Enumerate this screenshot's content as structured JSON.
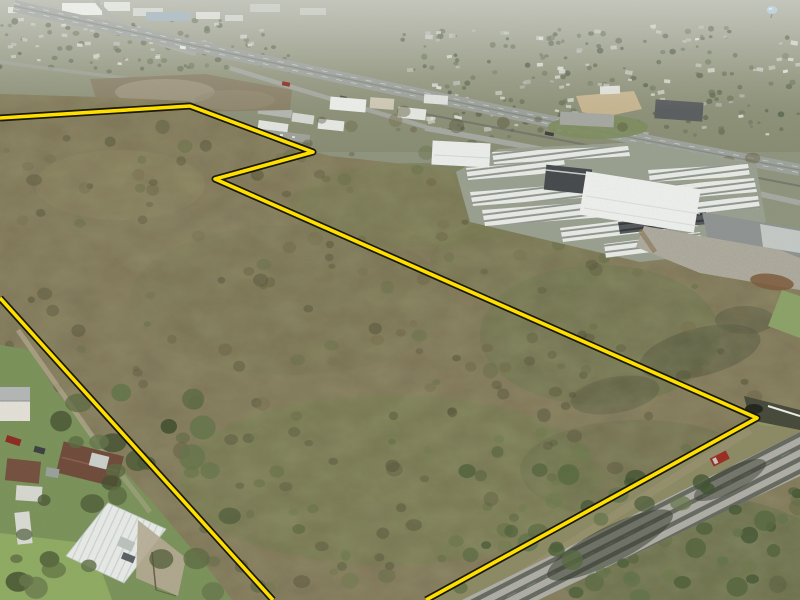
{
  "meta": {
    "type": "aerial-drone-photograph",
    "subject": "Aerial photo of wooded acreage for sale with yellow property boundary outline, bordered by a highway, RV dealership, rural road and small neighborhood",
    "width": 800,
    "height": 600
  },
  "palette": {
    "boundary_yellow": "#ffdf00",
    "boundary_outline": "#191807",
    "haze_top": "#aeb1a4",
    "suburb": "#8f947e",
    "forest_base": "#7d7254",
    "forest_green": "#6c7a47",
    "lawn_green": "#7b925a",
    "field_green": "#8fab62",
    "road_gray": "#aeaea6",
    "highway_gray": "#9da29d",
    "concrete": "#b1aea1",
    "warehouse_white": "#eef0ee",
    "truck_red": "#9a2c22"
  },
  "boundary": {
    "stroke_color": "#ffdf00",
    "outline_color": "#191807",
    "stroke_width": 3.6,
    "outline_width": 7,
    "polylines": [
      {
        "name": "northeast-boundary-line",
        "points": "0,118 190,106 313,152 215,179 757,418 426,600"
      },
      {
        "name": "west-boundary-line",
        "points": "0,298 273,600"
      }
    ]
  },
  "landmarks": [
    "wooded-parcel",
    "property-boundary",
    "interstate-highway",
    "frontage-road",
    "distant-city",
    "water-tower",
    "school-campus",
    "commercial-buildings",
    "rv-dealership",
    "warehouses",
    "concrete-pad",
    "country-road",
    "bridge-culvert",
    "red-pickup-truck",
    "neighborhood",
    "white-metal-building"
  ],
  "rv_rows": [
    {
      "pts": "492,152 628,146 630,156 494,164",
      "fill": "light"
    },
    {
      "pts": "466,168 564,160 566,172 468,180",
      "fill": "light"
    },
    {
      "pts": "470,192 604,182 607,196 473,206",
      "fill": "light"
    },
    {
      "pts": "482,210 642,198 645,214 485,226",
      "fill": "light"
    },
    {
      "pts": "560,228 662,216 665,230 563,242",
      "fill": "light"
    },
    {
      "pts": "604,244 700,232 702,246 606,258",
      "fill": "light"
    },
    {
      "pts": "648,170 748,164 750,176 650,182",
      "fill": "light"
    },
    {
      "pts": "656,186 754,178 757,192 659,200",
      "fill": "light"
    },
    {
      "pts": "664,204 758,196 760,208 666,216",
      "fill": "light"
    },
    {
      "pts": "618,222 706,212 708,224 620,234",
      "fill": "dark"
    }
  ],
  "scatter": [
    {
      "name": "suburb-houses-right",
      "kind": "rect",
      "region": [
        400,
        25,
        398,
        110
      ],
      "count": 95,
      "size": [
        2,
        4.5
      ],
      "colors": [
        "#e8e8e2",
        "#d8d8d0",
        "#c9ccc4",
        "#b8bcb4"
      ],
      "opacity": 0.9,
      "seed": 11
    },
    {
      "name": "suburb-houses-left",
      "kind": "rect",
      "region": [
        0,
        18,
        260,
        46
      ],
      "count": 42,
      "size": [
        2,
        4
      ],
      "colors": [
        "#e6e6df",
        "#cfd2ca",
        "#c2c6be"
      ],
      "opacity": 0.85,
      "seed": 12
    },
    {
      "name": "suburb-trees-right",
      "kind": "dot",
      "region": [
        395,
        28,
        405,
        112
      ],
      "count": 150,
      "size": [
        1.5,
        3.5
      ],
      "colors": [
        "#5f6a50",
        "#6b765a",
        "#55604a",
        "#727c62"
      ],
      "opacity": 0.8,
      "seed": 13
    },
    {
      "name": "suburb-trees-left",
      "kind": "dot",
      "region": [
        0,
        20,
        290,
        52
      ],
      "count": 70,
      "size": [
        1.5,
        3.5
      ],
      "colors": [
        "#636e54",
        "#6e785e",
        "#59644c"
      ],
      "opacity": 0.75,
      "seed": 14
    },
    {
      "name": "forest-clumps",
      "kind": "dot",
      "region": [
        5,
        110,
        750,
        330
      ],
      "count": 175,
      "size": [
        3,
        8
      ],
      "colors": [
        "#6b6243",
        "#59573c",
        "#776f4c",
        "#646e46",
        "#4f4f36"
      ],
      "opacity": 0.5,
      "seed": 21
    },
    {
      "name": "forest-clumps-lower",
      "kind": "dot",
      "region": [
        180,
        430,
        620,
        165
      ],
      "count": 90,
      "size": [
        4,
        9
      ],
      "colors": [
        "#5d6b40",
        "#4e5c36",
        "#6b7a4a",
        "#55533a"
      ],
      "opacity": 0.5,
      "seed": 22
    },
    {
      "name": "yard-trees",
      "kind": "dot",
      "region": [
        0,
        360,
        240,
        238
      ],
      "count": 30,
      "size": [
        6,
        14
      ],
      "colors": [
        "#4d5a36",
        "#5a6a40",
        "#435030",
        "#64744a"
      ],
      "opacity": 0.9,
      "seed": 31
    },
    {
      "name": "roadside-trees",
      "kind": "dot",
      "region": [
        460,
        470,
        340,
        128
      ],
      "count": 42,
      "size": [
        5,
        11
      ],
      "colors": [
        "#4c5f38",
        "#57693f",
        "#3f5230",
        "#62734a"
      ],
      "opacity": 0.85,
      "seed": 41
    }
  ]
}
